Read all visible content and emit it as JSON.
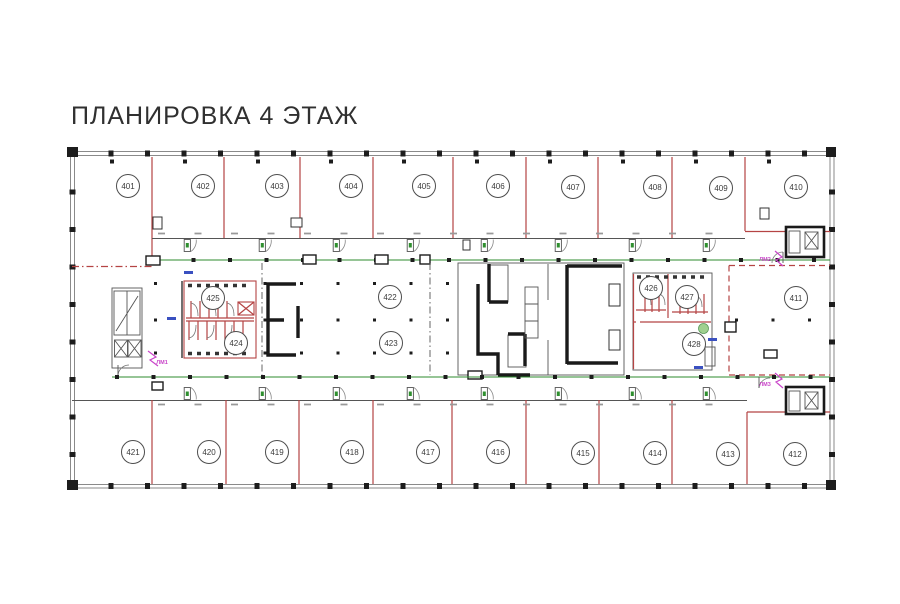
{
  "title": "ПЛАНИРОВКА 4 ЭТАЖ",
  "colors": {
    "wall_red": "#b54444",
    "corridor_green": "#2e8b2e",
    "core_black": "#1a1a1a",
    "outer_gray": "#8a8a8a",
    "marker_black": "#1d1d1d",
    "label_magenta": "#c944c9",
    "mark_blue": "#3a50c0",
    "fixture_green": "#9fd08f"
  },
  "rooms": [
    {
      "id": "401",
      "cx": 128,
      "cy": 186
    },
    {
      "id": "402",
      "cx": 203,
      "cy": 186
    },
    {
      "id": "403",
      "cx": 277,
      "cy": 186
    },
    {
      "id": "404",
      "cx": 351,
      "cy": 186
    },
    {
      "id": "405",
      "cx": 424,
      "cy": 186
    },
    {
      "id": "406",
      "cx": 498,
      "cy": 186
    },
    {
      "id": "407",
      "cx": 573,
      "cy": 187
    },
    {
      "id": "408",
      "cx": 655,
      "cy": 187
    },
    {
      "id": "409",
      "cx": 721,
      "cy": 188
    },
    {
      "id": "410",
      "cx": 796,
      "cy": 187
    },
    {
      "id": "411",
      "cx": 796,
      "cy": 298
    },
    {
      "id": "412",
      "cx": 795,
      "cy": 454
    },
    {
      "id": "413",
      "cx": 728,
      "cy": 454
    },
    {
      "id": "414",
      "cx": 655,
      "cy": 453
    },
    {
      "id": "415",
      "cx": 583,
      "cy": 453
    },
    {
      "id": "416",
      "cx": 498,
      "cy": 452
    },
    {
      "id": "417",
      "cx": 428,
      "cy": 452
    },
    {
      "id": "418",
      "cx": 352,
      "cy": 452
    },
    {
      "id": "419",
      "cx": 277,
      "cy": 452
    },
    {
      "id": "420",
      "cx": 209,
      "cy": 452
    },
    {
      "id": "421",
      "cx": 133,
      "cy": 452
    },
    {
      "id": "422",
      "cx": 390,
      "cy": 297
    },
    {
      "id": "423",
      "cx": 391,
      "cy": 343
    },
    {
      "id": "424",
      "cx": 236,
      "cy": 343
    },
    {
      "id": "425",
      "cx": 213,
      "cy": 298
    },
    {
      "id": "426",
      "cx": 651,
      "cy": 288
    },
    {
      "id": "427",
      "cx": 687,
      "cy": 297
    },
    {
      "id": "428",
      "cx": 694,
      "cy": 344
    }
  ],
  "stair_labels": [
    {
      "text": "ЛМ1",
      "x": 162,
      "y": 364
    },
    {
      "text": "ЛМ2",
      "x": 765,
      "y": 261
    },
    {
      "text": "ЛМ3",
      "x": 765,
      "y": 386
    }
  ]
}
